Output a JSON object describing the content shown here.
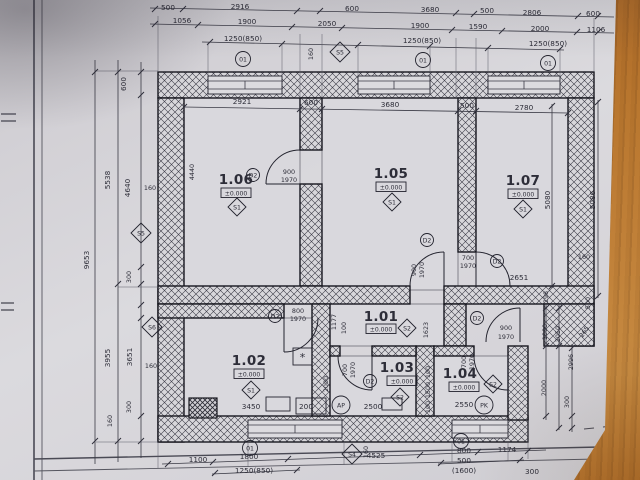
{
  "rooms": {
    "r106": {
      "number": "1.06",
      "level": "±0.000",
      "floor": "S1"
    },
    "r105": {
      "number": "1.05",
      "level": "±0.000",
      "floor": "S1"
    },
    "r107": {
      "number": "1.07",
      "level": "±0.000",
      "floor": "S1"
    },
    "r101": {
      "number": "1.01",
      "level": "±0.000",
      "floor": "S2"
    },
    "r102": {
      "number": "1.02",
      "level": "±0.000",
      "floor": "S1"
    },
    "r103": {
      "number": "1.03",
      "level": "±0.000",
      "floor": "S2"
    },
    "r104": {
      "number": "1.04",
      "level": "±0.000",
      "floor": "S2"
    }
  },
  "doors": {
    "mark": "D2",
    "d106": {
      "w": "900",
      "h": "1970"
    },
    "d105": {
      "w": "900",
      "h": "1970"
    },
    "d107": {
      "w": "700",
      "h": "1970"
    },
    "d102": {
      "w": "800",
      "h": "1970"
    },
    "d103": {
      "w": "700",
      "h": "1970"
    },
    "d104": {
      "w": "700",
      "h": "1970"
    },
    "dext": {
      "w": "900",
      "h": "1970"
    }
  },
  "window_mark": "01",
  "equipment": {
    "ap": "AP",
    "pk": "PK",
    "note": "*"
  },
  "section_marks": {
    "s4": "S4",
    "s5": "S5",
    "s6": "S6"
  },
  "dims": {
    "top1": [
      "500",
      "2916",
      "600",
      "3680",
      "500",
      "2806",
      "600"
    ],
    "top2": [
      "1056",
      "1900",
      "2050",
      "1900",
      "1590",
      "2000",
      "1106"
    ],
    "top3": [
      "1250(850)",
      "1250(850)",
      "1250(850)"
    ],
    "top_s160": "160",
    "top_inner": [
      "2921",
      "600",
      "3680",
      "500",
      "2780"
    ],
    "left": {
      "w600": "600",
      "h5538": "5538",
      "h4640": "4640",
      "s160": "160",
      "h9653": "9653",
      "h300a": "300",
      "h3955": "3955",
      "h3651": "3651",
      "s160b": "160",
      "h300b": "300",
      "s160c": "160"
    },
    "right": {
      "h5080": "5080",
      "h5086": "5086",
      "s160": "160",
      "h298": "298",
      "h500": "500",
      "h265": "265",
      "h1000": "1000",
      "h2050": "2050",
      "h2996": "2996",
      "h2000": "2000",
      "h300": "300",
      "w2651": "2651"
    },
    "bottom1": [
      "1100",
      "1800",
      "4525",
      "800",
      "1174"
    ],
    "bottom2": [
      "1250(850)",
      "500",
      "(1600)",
      "300"
    ],
    "bottom_s160": "160",
    "inner": {
      "v4440": "4440",
      "v1177": "1177",
      "v100a": "100",
      "v1623": "1623",
      "v2000": "2000",
      "w2500": "2500",
      "v100b": "100",
      "w2550": "2550",
      "v1500": "1500",
      "v100c": "100",
      "w3450": "3450",
      "w200": "200"
    }
  }
}
